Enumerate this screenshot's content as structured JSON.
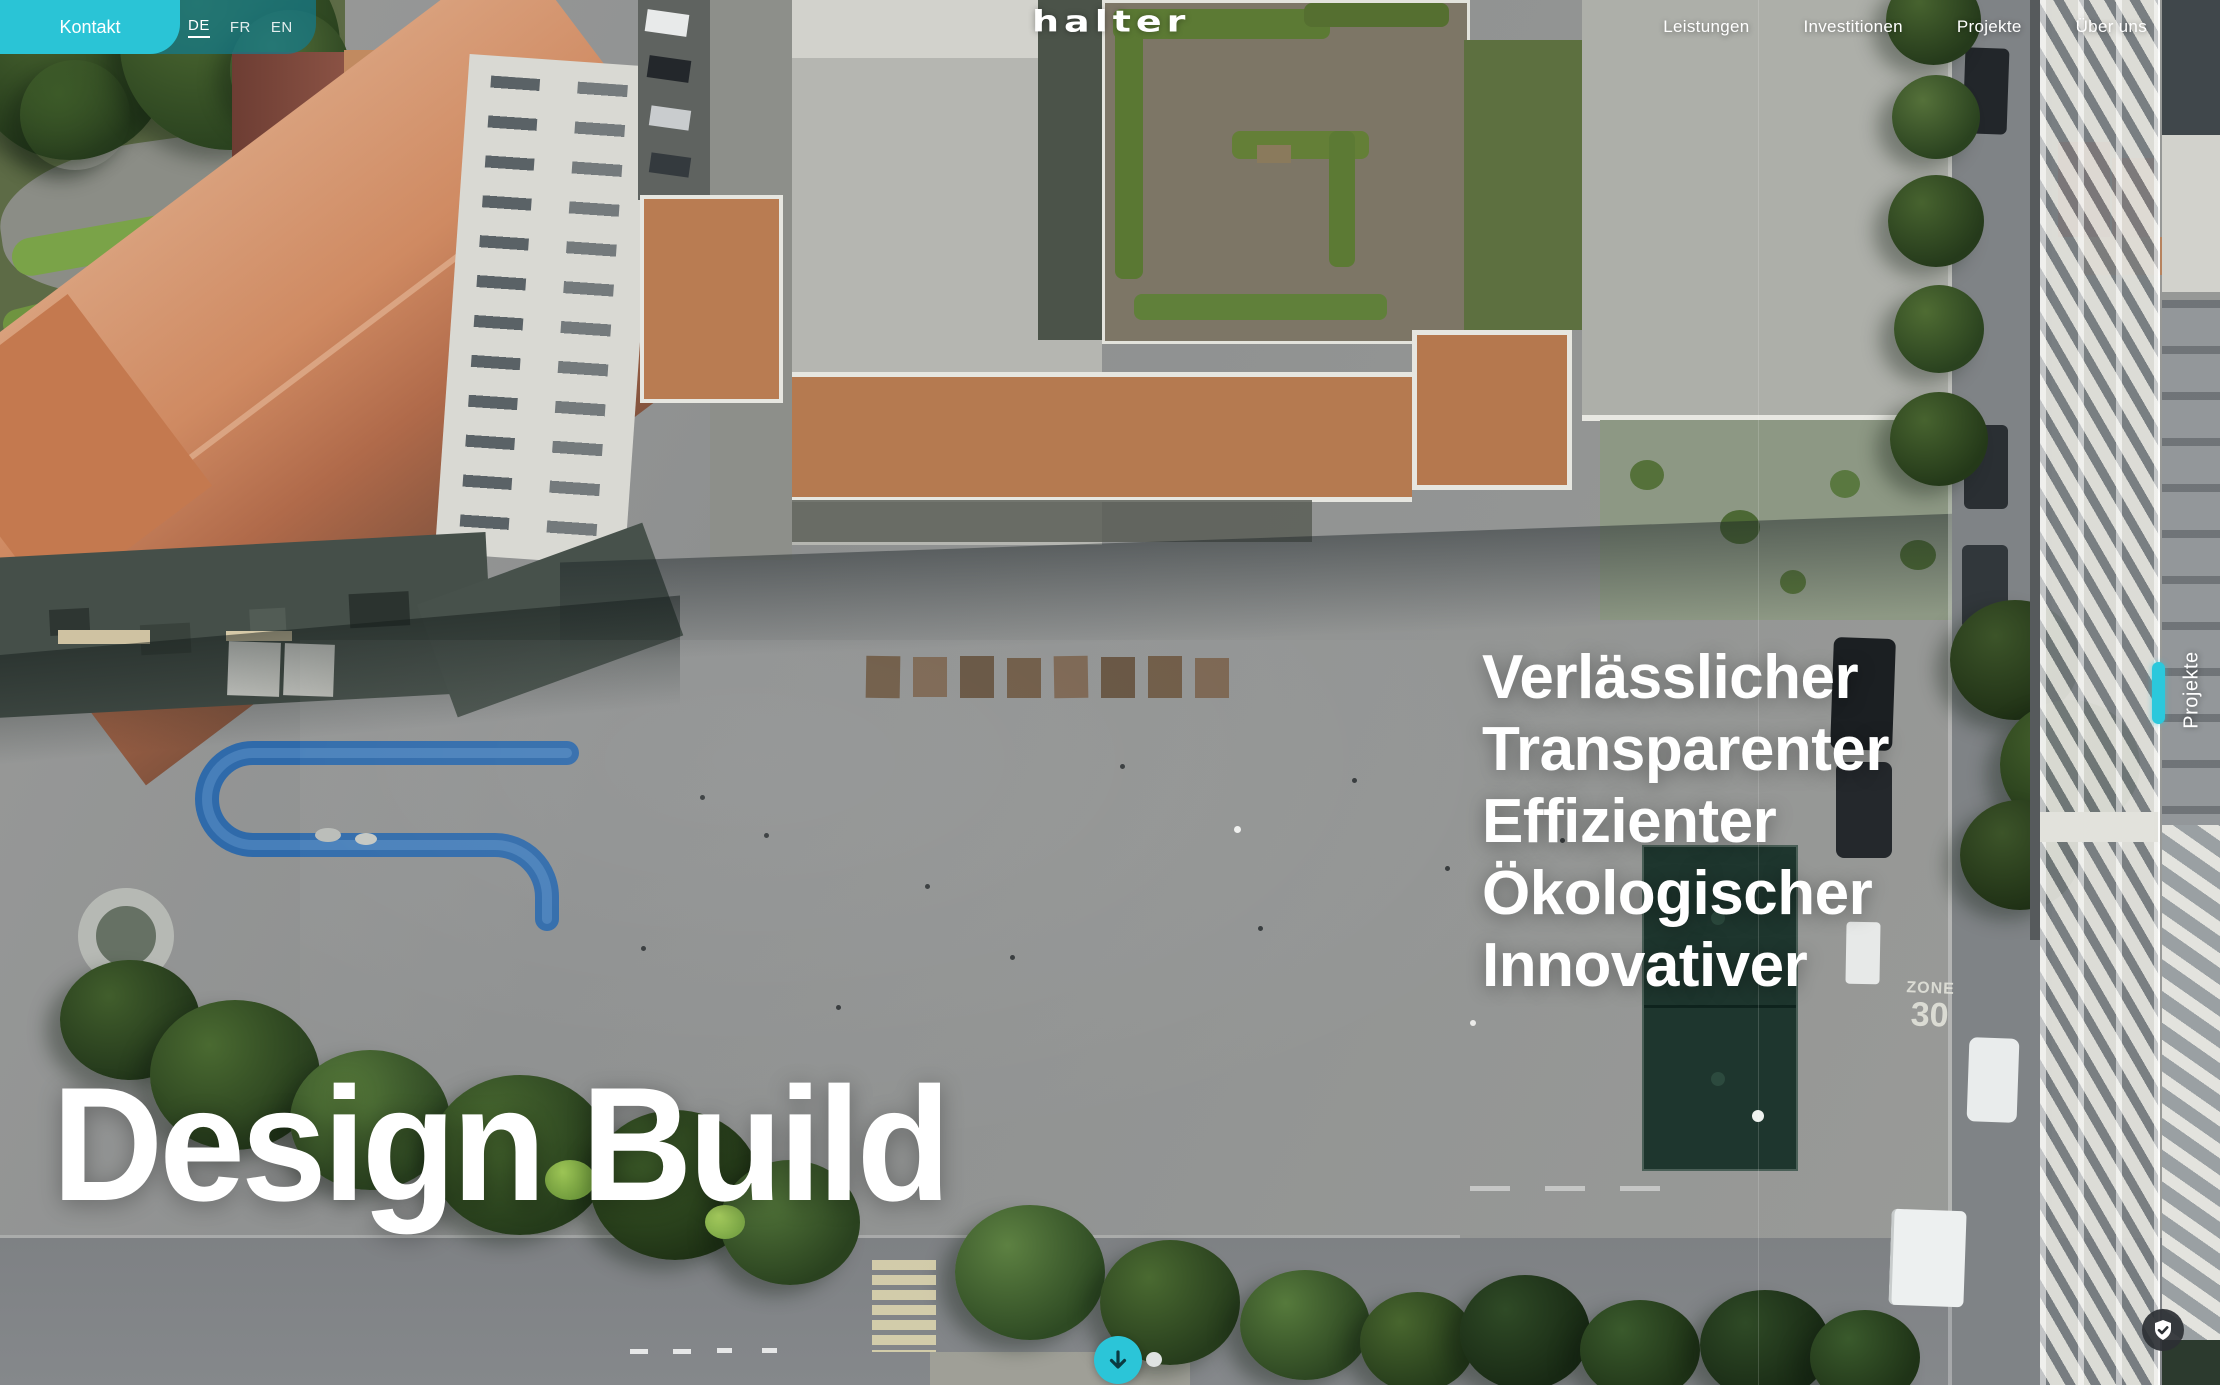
{
  "header": {
    "contact_label": "Kontakt",
    "languages": [
      {
        "code": "DE",
        "active": true
      },
      {
        "code": "FR",
        "active": false
      },
      {
        "code": "EN",
        "active": false
      }
    ],
    "logo_text": "halter",
    "nav_items": [
      {
        "label": "Leistungen"
      },
      {
        "label": "Investitionen"
      },
      {
        "label": "Projekte"
      },
      {
        "label": "Über uns"
      }
    ]
  },
  "hero": {
    "keywords": [
      "Verlässlicher",
      "Transparenter",
      "Effizienter",
      "Ökologischer",
      "Innovativer"
    ],
    "headline": "Design Build"
  },
  "side_rail": {
    "label": "Projekte"
  },
  "photo": {
    "road_marking_line1": "ZONE",
    "road_marking_line2": "30"
  },
  "icons": {
    "scroll_down": "arrow-down-icon",
    "privacy": "shield-check-icon"
  },
  "colors": {
    "accent": "#2AC4D6",
    "rail_indicator": "#2BC8DC",
    "language_bar": "rgba(20,122,139,0.72)"
  }
}
